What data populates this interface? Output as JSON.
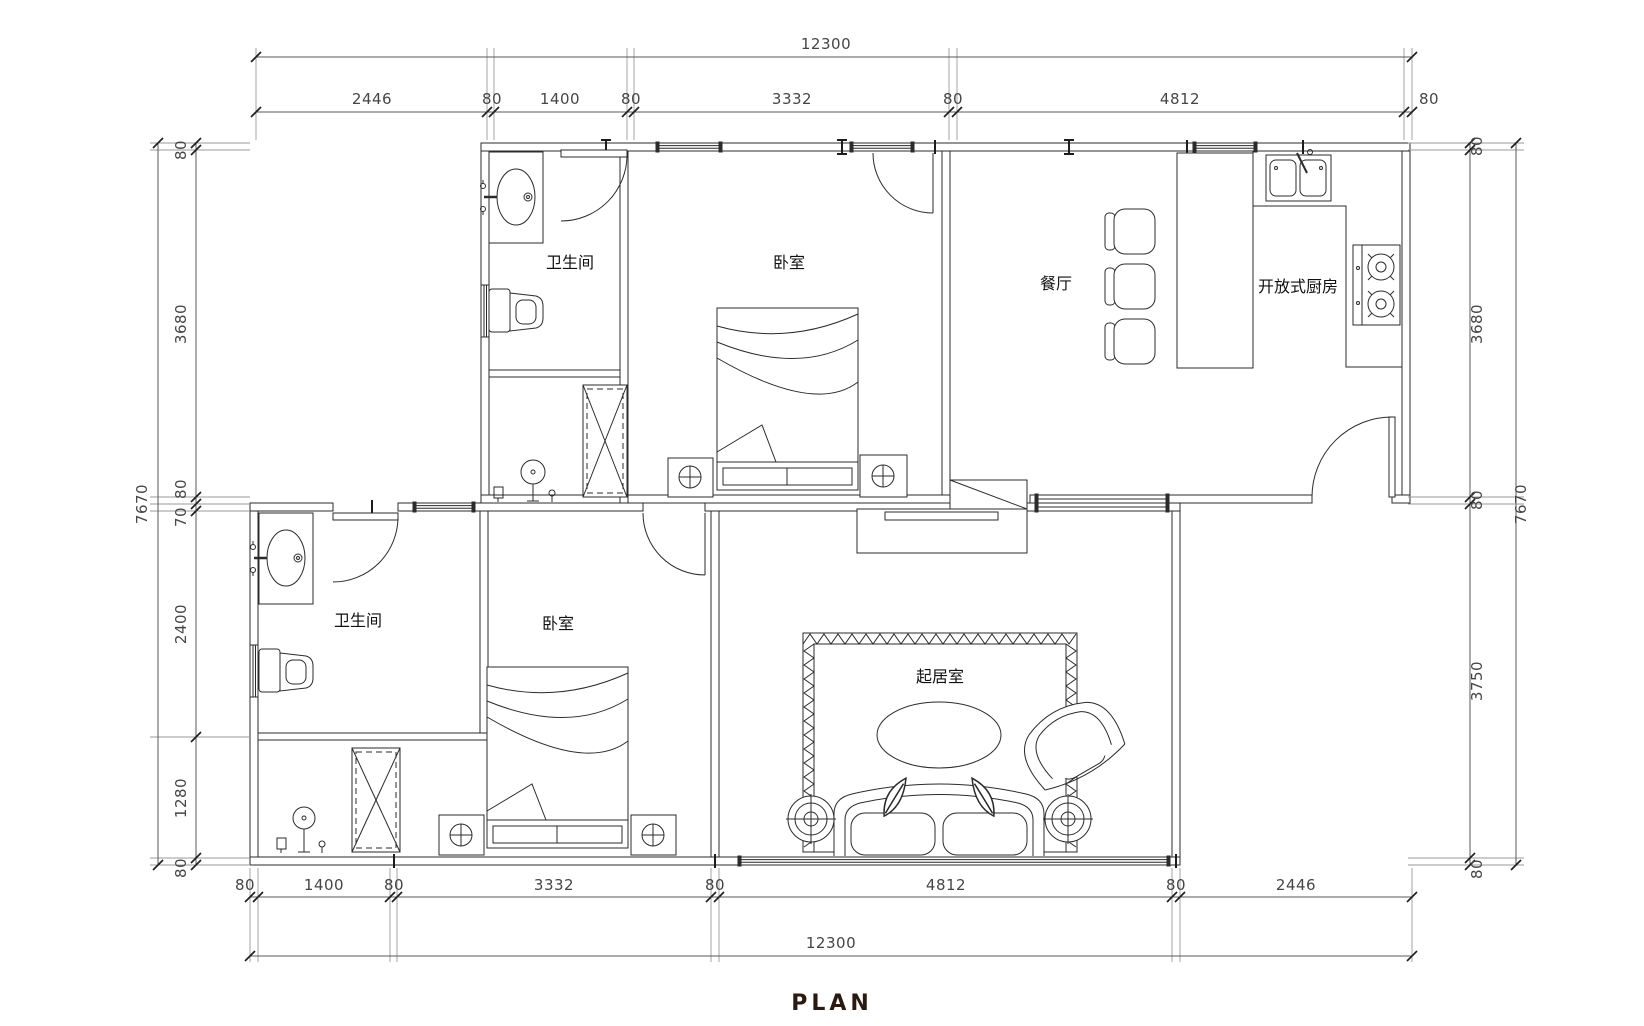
{
  "title": "PLAN",
  "rooms": {
    "bathroom_upper": "卫生间",
    "bedroom_upper": "卧室",
    "dining": "餐厅",
    "kitchen": "开放式厨房",
    "bathroom_lower": "卫生间",
    "bedroom_lower": "卧室",
    "living": "起居室"
  },
  "dimensions": {
    "top_overall": "12300",
    "top_chain": [
      "2446",
      "80",
      "1400",
      "80",
      "3332",
      "80",
      "4812",
      "80"
    ],
    "bottom_overall": "12300",
    "bottom_chain": [
      "80",
      "1400",
      "80",
      "3332",
      "80",
      "4812",
      "80",
      "2446"
    ],
    "left_overall": "7670",
    "left_chain": [
      "80",
      "3680",
      "80",
      "70",
      "2400",
      "1280",
      "80"
    ],
    "right_overall": "7670",
    "right_chain": [
      "80",
      "3680",
      "80",
      "3750",
      "80"
    ]
  },
  "colors": {
    "wall_line": "#2b2b2b",
    "dimension_line": "#5a5a5a",
    "extension_line": "#9a9a9a",
    "title_color": "#2a1a12"
  }
}
